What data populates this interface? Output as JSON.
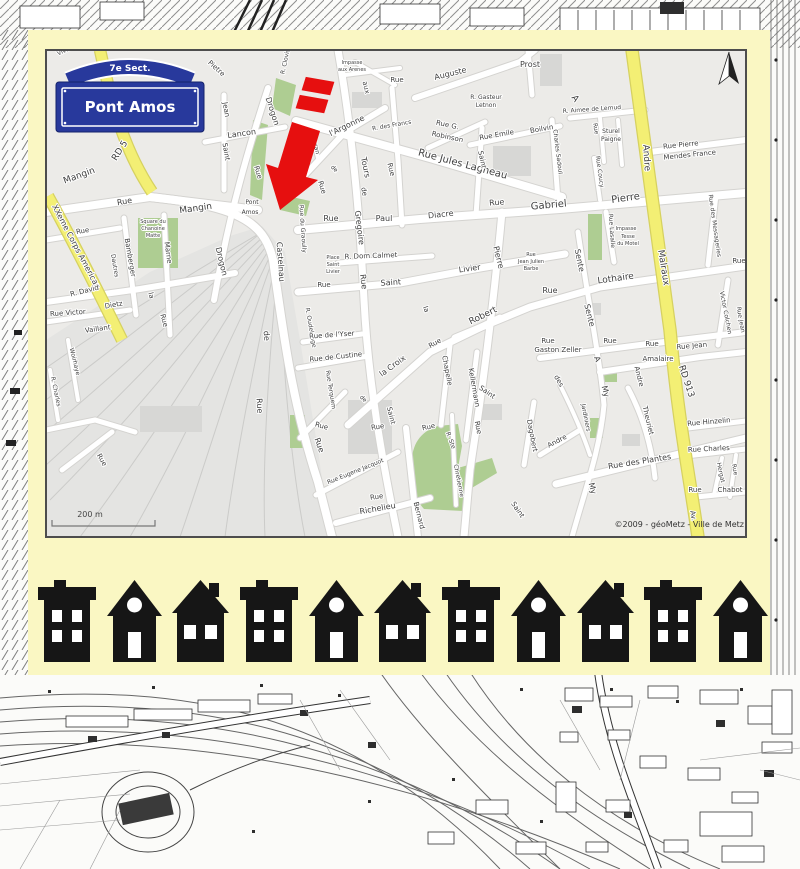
{
  "sign": {
    "sector": "7e Sect.",
    "name": "Pont Amos"
  },
  "map": {
    "scale_label": "200 m",
    "attribution": "©2009 - géoMetz - Ville de Metz",
    "colors": {
      "card": "#faf7c3",
      "road_major": "#f3ef74",
      "park": "#aecd92",
      "arrow_red": "#e60f0f",
      "sign_blue": "#28399c",
      "house_black": "#161616"
    },
    "labels": [
      [
        "Vivier",
        66,
        52,
        -25,
        6
      ],
      [
        "RD 5",
        122,
        152,
        -58,
        9
      ],
      [
        "Mangin",
        80,
        178,
        -20,
        9
      ],
      [
        "Rue",
        83,
        233,
        -10,
        7
      ],
      [
        "XXeme Corps American",
        74,
        248,
        62,
        8
      ],
      [
        "Pietre",
        215,
        70,
        42,
        7
      ],
      [
        "R. Clovis",
        287,
        62,
        -78,
        6
      ],
      [
        "Jean",
        224,
        110,
        80,
        7
      ],
      [
        "Saint",
        224,
        152,
        80,
        7
      ],
      [
        "Lancon",
        242,
        136,
        -8,
        8
      ],
      [
        "Drogon",
        270,
        112,
        72,
        8
      ],
      [
        "Rue",
        256,
        173,
        72,
        7
      ],
      [
        "Drogon",
        219,
        262,
        76,
        8
      ],
      [
        "Bamberger",
        128,
        258,
        80,
        7
      ],
      [
        "Dautres",
        113,
        266,
        80,
        6
      ],
      [
        "Marne",
        166,
        253,
        82,
        7
      ],
      [
        "R. David",
        85,
        293,
        -14,
        7
      ],
      [
        "Dietz",
        114,
        307,
        -10,
        7
      ],
      [
        "Rue Victor",
        68,
        315,
        -4,
        7
      ],
      [
        "Vaillant",
        98,
        331,
        -8,
        7
      ],
      [
        "la",
        149,
        296,
        75,
        7
      ],
      [
        "Rue",
        162,
        321,
        75,
        7
      ],
      [
        "Rue",
        100,
        461,
        60,
        7
      ],
      [
        "Woirhaye",
        73,
        362,
        76,
        6
      ],
      [
        "R. Charles",
        54,
        392,
        78,
        6
      ],
      [
        "Rue",
        125,
        204,
        -10,
        8
      ],
      [
        "Mangin",
        196,
        211,
        -8,
        9
      ],
      [
        "Pont",
        252,
        204,
        0,
        6
      ],
      [
        "Amos",
        250,
        214,
        0,
        6
      ],
      [
        "Square du",
        153,
        223,
        0,
        5
      ],
      [
        "Chanoine",
        153,
        230,
        0,
        5
      ],
      [
        "Matte",
        153,
        237,
        0,
        5
      ],
      [
        "Impasse",
        352,
        64,
        0,
        5
      ],
      [
        "aux Arenes",
        352,
        71,
        0,
        5
      ],
      [
        "Rue",
        397,
        82,
        0,
        7
      ],
      [
        "aux",
        364,
        88,
        76,
        7
      ],
      [
        "Auguste",
        451,
        76,
        -14,
        8
      ],
      [
        "Prost",
        530,
        67,
        0,
        8
      ],
      [
        "R. des Francs",
        392,
        127,
        -10,
        6
      ],
      [
        "l'Argonne",
        348,
        128,
        -26,
        8
      ],
      [
        "Rue",
        320,
        188,
        72,
        7
      ],
      [
        "de",
        333,
        170,
        45,
        6
      ],
      [
        "Mazeran",
        313,
        142,
        76,
        6
      ],
      [
        "Tours",
        363,
        168,
        78,
        8
      ],
      [
        "de",
        362,
        192,
        78,
        7
      ],
      [
        "Gregoire",
        357,
        228,
        83,
        8
      ],
      [
        "Rue",
        361,
        282,
        83,
        8
      ],
      [
        "Rue",
        389,
        170,
        76,
        7
      ],
      [
        "Rue Jules Lagneau",
        462,
        167,
        15,
        10
      ],
      [
        "Rue G.",
        447,
        127,
        12,
        7
      ],
      [
        "Robinson",
        447,
        139,
        12,
        7
      ],
      [
        "Rue Emile",
        497,
        137,
        -10,
        7
      ],
      [
        "Boilvin",
        542,
        131,
        -10,
        7
      ],
      [
        "R. Gasteur",
        486,
        99,
        0,
        6
      ],
      [
        "Letnon",
        486,
        107,
        0,
        6
      ],
      [
        "Saint",
        480,
        160,
        78,
        7
      ],
      [
        "Charles Sadoul",
        556,
        152,
        83,
        6
      ],
      [
        "A",
        573,
        100,
        55,
        9
      ],
      [
        "R. Aimee de Lemud",
        592,
        111,
        -4,
        6
      ],
      [
        "Rue",
        594,
        129,
        80,
        6
      ],
      [
        "Sturel",
        611,
        133,
        0,
        6
      ],
      [
        "Paigne",
        611,
        141,
        0,
        6
      ],
      [
        "Rue Coucy",
        598,
        172,
        82,
        6
      ],
      [
        "Andre",
        644,
        158,
        86,
        9
      ],
      [
        "Rue Pierre",
        681,
        147,
        -6,
        7
      ],
      [
        "Mendes France",
        690,
        157,
        -6,
        7
      ],
      [
        "Rue des Messageries",
        713,
        226,
        82,
        6
      ],
      [
        "Pierre",
        626,
        201,
        -8,
        10
      ],
      [
        "Gabriel",
        549,
        208,
        -5,
        10
      ],
      [
        "Rue",
        497,
        205,
        -5,
        8
      ],
      [
        "Malraux",
        661,
        268,
        81,
        9
      ],
      [
        "Rue Lasalle",
        610,
        231,
        86,
        6
      ],
      [
        "Impasse",
        626,
        230,
        0,
        5
      ],
      [
        "Tesse",
        628,
        238,
        0,
        5
      ],
      [
        "du Motel",
        628,
        245,
        0,
        5
      ],
      [
        "Lothaire",
        616,
        281,
        -8,
        9
      ],
      [
        "Rue",
        550,
        293,
        0,
        8
      ],
      [
        "Sente",
        577,
        261,
        78,
        8
      ],
      [
        "Sente",
        587,
        316,
        76,
        8
      ],
      [
        "A",
        595,
        360,
        70,
        8
      ],
      [
        "My",
        603,
        392,
        76,
        8
      ],
      [
        "My",
        590,
        489,
        76,
        8
      ],
      [
        "Rue",
        548,
        343,
        0,
        7
      ],
      [
        "Gaston Zeller",
        558,
        352,
        0,
        7
      ],
      [
        "Rue",
        610,
        343,
        0,
        7
      ],
      [
        "Rue",
        652,
        346,
        0,
        7
      ],
      [
        "Amalaire",
        658,
        361,
        0,
        7
      ],
      [
        "Rue Jean",
        692,
        348,
        -5,
        7
      ],
      [
        "Victor Colchen",
        724,
        313,
        79,
        6
      ],
      [
        "Rue",
        739,
        263,
        0,
        7
      ],
      [
        "Rue Jean",
        739,
        320,
        80,
        6
      ],
      [
        "RD 913",
        684,
        382,
        72,
        9
      ],
      [
        "Av.",
        691,
        516,
        80,
        7
      ],
      [
        "Rue Hinzelin",
        709,
        424,
        -5,
        7
      ],
      [
        "Rue Charles",
        709,
        451,
        -3,
        7
      ],
      [
        "Hergat",
        719,
        473,
        78,
        6
      ],
      [
        "Rue",
        733,
        470,
        78,
        6
      ],
      [
        "Rue",
        695,
        492,
        0,
        7
      ],
      [
        "Chabot",
        730,
        492,
        0,
        7
      ],
      [
        "Rue des Plantes",
        640,
        464,
        -9,
        8
      ],
      [
        "Theuriet",
        646,
        421,
        76,
        7
      ],
      [
        "Andre",
        637,
        377,
        76,
        7
      ],
      [
        "Andre",
        558,
        443,
        -28,
        7
      ],
      [
        "des",
        557,
        382,
        60,
        7
      ],
      [
        "Jardiniers",
        584,
        418,
        79,
        6
      ],
      [
        "Rue",
        331,
        221,
        0,
        8
      ],
      [
        "Paul",
        384,
        221,
        0,
        8
      ],
      [
        "Diacre",
        441,
        217,
        -6,
        8
      ],
      [
        "Rue du Graoully",
        301,
        229,
        86,
        6
      ],
      [
        "Place",
        333,
        259,
        0,
        5
      ],
      [
        "Saint",
        333,
        266,
        0,
        5
      ],
      [
        "Livier",
        333,
        273,
        0,
        5
      ],
      [
        "R. Dom Calmet",
        371,
        258,
        -2,
        7
      ],
      [
        "Rue",
        324,
        287,
        0,
        7
      ],
      [
        "Saint",
        391,
        285,
        -4,
        8
      ],
      [
        "Livier",
        470,
        271,
        -8,
        8
      ],
      [
        "la",
        424,
        310,
        70,
        7
      ],
      [
        "Rue",
        436,
        345,
        -30,
        7
      ],
      [
        "la Croix",
        394,
        368,
        -36,
        8
      ],
      [
        "Chapelle",
        445,
        371,
        79,
        7
      ],
      [
        "Kellermann",
        472,
        388,
        80,
        7
      ],
      [
        "Robert",
        484,
        318,
        -26,
        9
      ],
      [
        "Pierre",
        496,
        258,
        76,
        8
      ],
      [
        "Rue",
        531,
        256,
        0,
        5
      ],
      [
        "Jean Julien",
        531,
        263,
        0,
        5
      ],
      [
        "Barbe",
        531,
        270,
        0,
        5
      ],
      [
        "R. Oudelange",
        309,
        328,
        80,
        6
      ],
      [
        "Rue de l'Yser",
        332,
        337,
        -4,
        7
      ],
      [
        "Rue de Custine",
        336,
        359,
        -6,
        7
      ],
      [
        "Saint",
        486,
        394,
        35,
        7
      ],
      [
        "Saint",
        516,
        511,
        55,
        7
      ],
      [
        "Dagobert",
        530,
        436,
        79,
        7
      ],
      [
        "R. Ste",
        449,
        441,
        70,
        6
      ],
      [
        "Chretienne",
        457,
        481,
        79,
        6
      ],
      [
        "Rue",
        476,
        428,
        79,
        7
      ],
      [
        "Rue",
        429,
        429,
        -12,
        7
      ],
      [
        "Rue",
        378,
        429,
        -8,
        7
      ],
      [
        "Saint",
        389,
        416,
        76,
        7
      ],
      [
        "Bernard",
        417,
        516,
        76,
        7
      ],
      [
        "Rue Terquem",
        329,
        390,
        81,
        6
      ],
      [
        "de",
        362,
        400,
        45,
        6
      ],
      [
        "Rue",
        321,
        428,
        15,
        7
      ],
      [
        "Rue",
        317,
        446,
        70,
        8
      ],
      [
        "Rue Eugene Jacquot",
        356,
        473,
        -22,
        6
      ],
      [
        "Rue",
        377,
        499,
        -8,
        7
      ],
      [
        "Richelieu",
        378,
        511,
        -10,
        8
      ],
      [
        "Castelnau",
        278,
        262,
        86,
        8
      ],
      [
        "de",
        264,
        336,
        86,
        8
      ],
      [
        "Rue",
        257,
        406,
        86,
        8
      ]
    ]
  },
  "houses": {
    "pattern": [
      "flat",
      "gable",
      "chimney",
      "flat",
      "gable",
      "chimney",
      "flat",
      "gable",
      "chimney",
      "flat",
      "gable"
    ]
  }
}
